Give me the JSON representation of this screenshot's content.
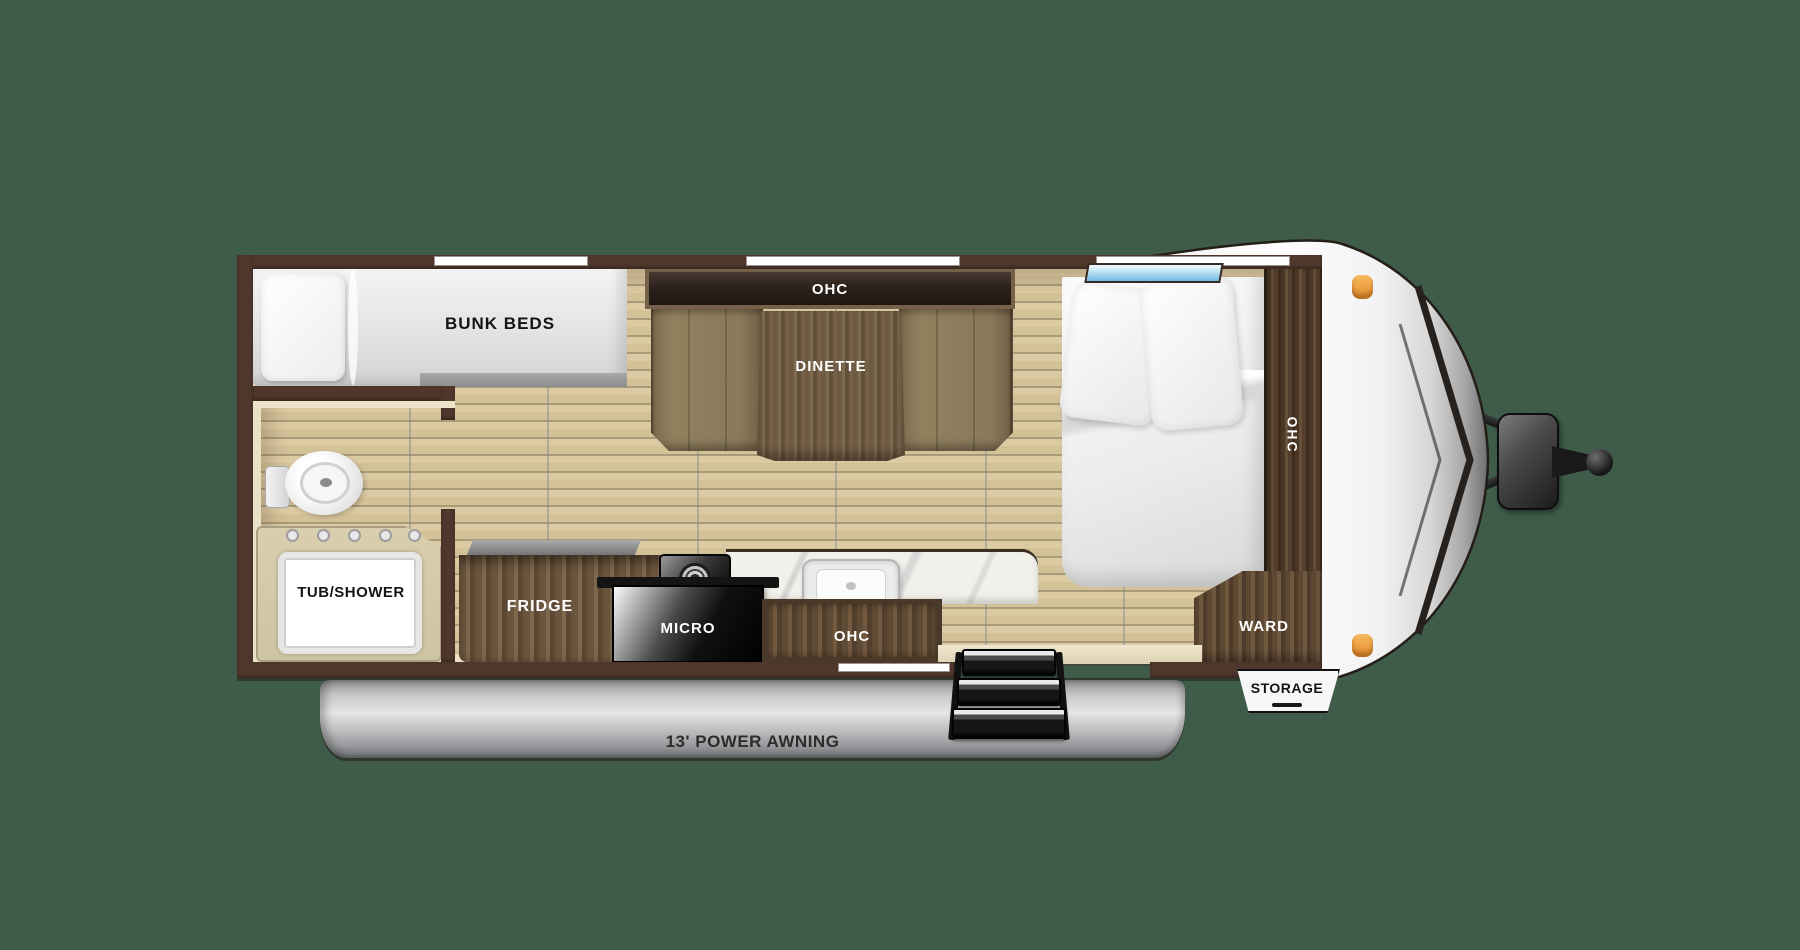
{
  "labels": {
    "bunk_beds": "BUNK BEDS",
    "dinette_ohc": "OHC",
    "dinette": "DINETTE",
    "tub_shower": "TUB/SHOWER",
    "fridge": "FRIDGE",
    "micro": "MICRO",
    "kitchen_ohc": "OHC",
    "bed_ohc": "OHC",
    "ward": "WARD",
    "storage": "STORAGE",
    "awning": "13' POWER AWNING"
  },
  "colors": {
    "background": "#3e5c49",
    "wall_brown": "#4f372c",
    "interior_cream": "#eae0c5",
    "floor_tan": "#d7c69e",
    "cabinet_wood": "#5f4a33",
    "awning_silver": "#c7c8ca",
    "clearance_light_orange": "#eea043",
    "window_blue": "#8fd0ec"
  }
}
